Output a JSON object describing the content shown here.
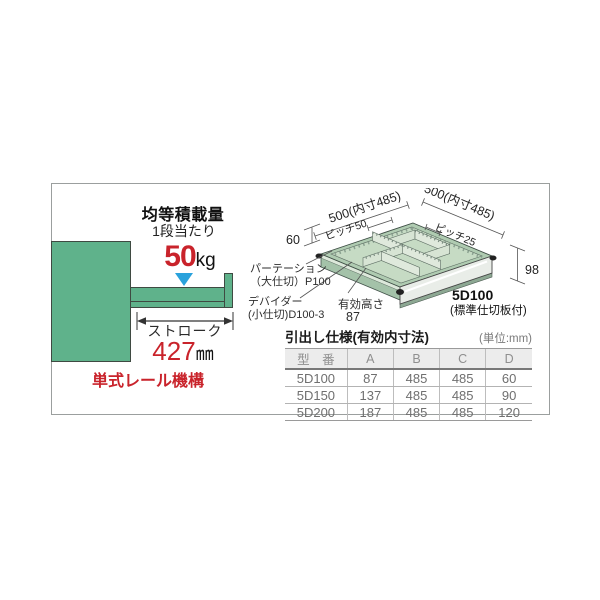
{
  "left_panel": {
    "load_title": "均等積載量",
    "load_subtitle": "1段当たり",
    "load_value": "50",
    "load_unit": "kg",
    "stroke_label": "ストローク",
    "stroke_value": "427",
    "stroke_unit": "㎜",
    "rail_label": "単式レール機構"
  },
  "diagram": {
    "dim_left": "500(内寸485)",
    "dim_right": "500(内寸485)",
    "pitch_left": "ピッチ50",
    "pitch_right": "ピッチ25",
    "dim_back_height": "60",
    "dim_front_height": "98",
    "partition_label_1": "パーテーション",
    "partition_label_2": "（大仕切）P100",
    "divider_label_1": "デバイダー",
    "divider_label_2": "(小仕切)D100-3",
    "effective_height_label": "有効高さ",
    "effective_height_value": "87",
    "model": "5D100",
    "model_note": "(標準仕切板付)"
  },
  "table": {
    "title": "引出し仕様(有効内寸法)",
    "unit_note": "(単位:mm)",
    "headers": [
      "型　番",
      "A",
      "B",
      "C",
      "D"
    ],
    "rows": [
      [
        "5D100",
        "87",
        "485",
        "485",
        "60"
      ],
      [
        "5D150",
        "137",
        "485",
        "485",
        "90"
      ],
      [
        "5D200",
        "187",
        "485",
        "485",
        "120"
      ]
    ]
  },
  "colors": {
    "cabinet_green": "#5fb28b",
    "tray_green_light": "#c6dbc4",
    "accent_red": "#c9232b",
    "pointer_blue": "#2aa2dc"
  }
}
